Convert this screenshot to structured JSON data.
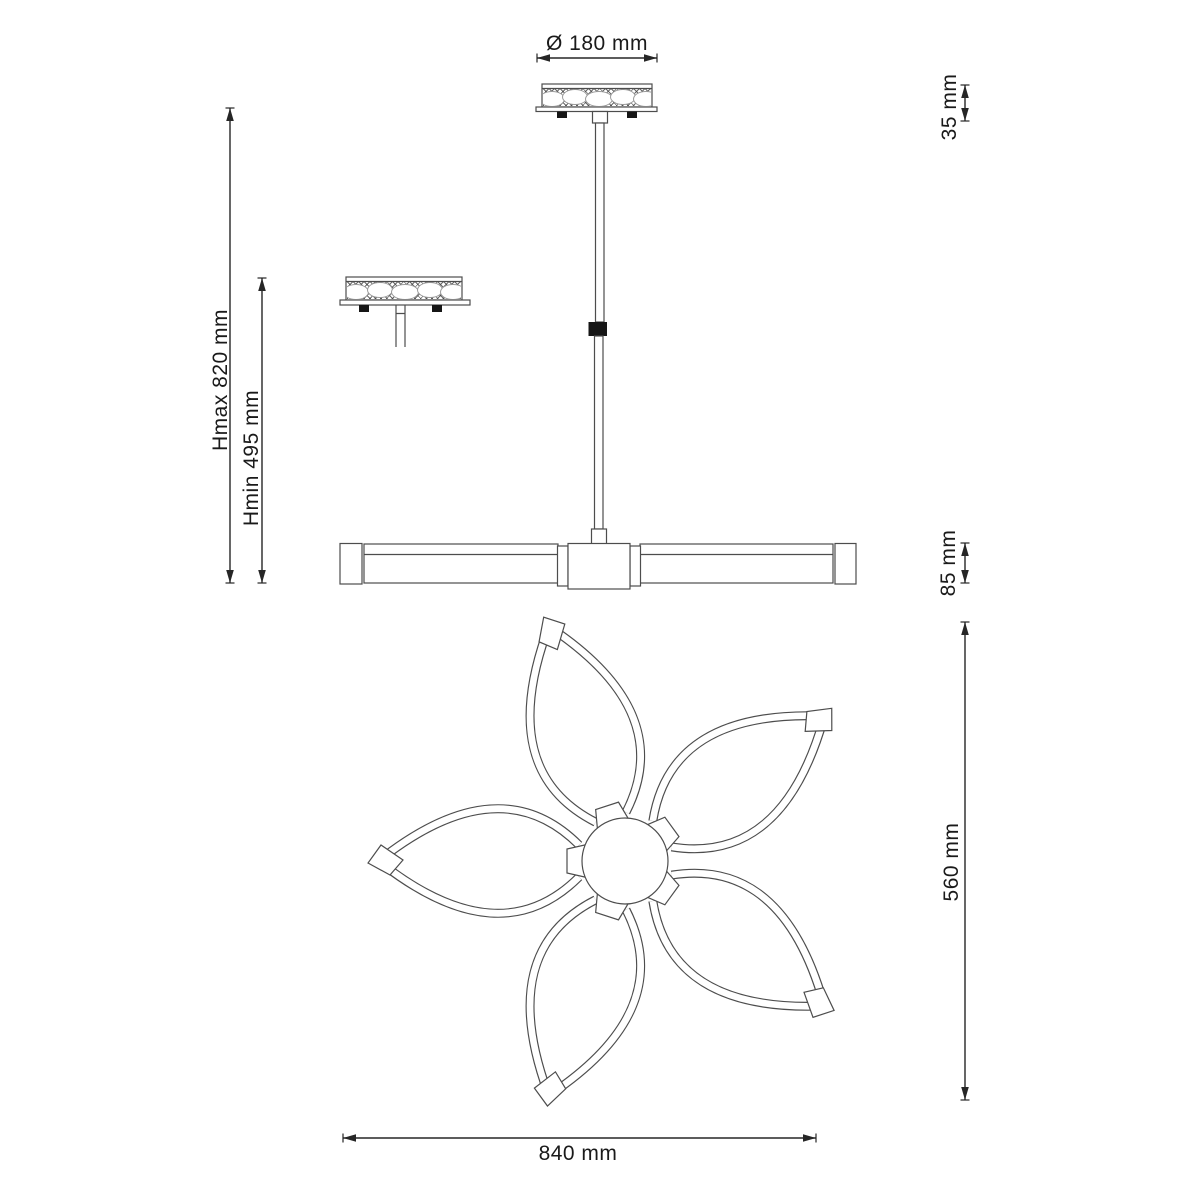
{
  "drawing": {
    "subject": "pendant-lamp-dimension-drawing"
  },
  "dimensions": {
    "canopy_diameter": "Ø 180 mm",
    "canopy_height": "35 mm",
    "height_max": "Hmax 820 mm",
    "height_min": "Hmin 495 mm",
    "bar_height": "85 mm",
    "top_view_height": "560 mm",
    "top_view_width": "840 mm"
  },
  "colors": {
    "background": "#ffffff",
    "line": "#4d4d4d",
    "dim": "#262626",
    "text": "#1a1a1a",
    "dark": "#161616"
  }
}
